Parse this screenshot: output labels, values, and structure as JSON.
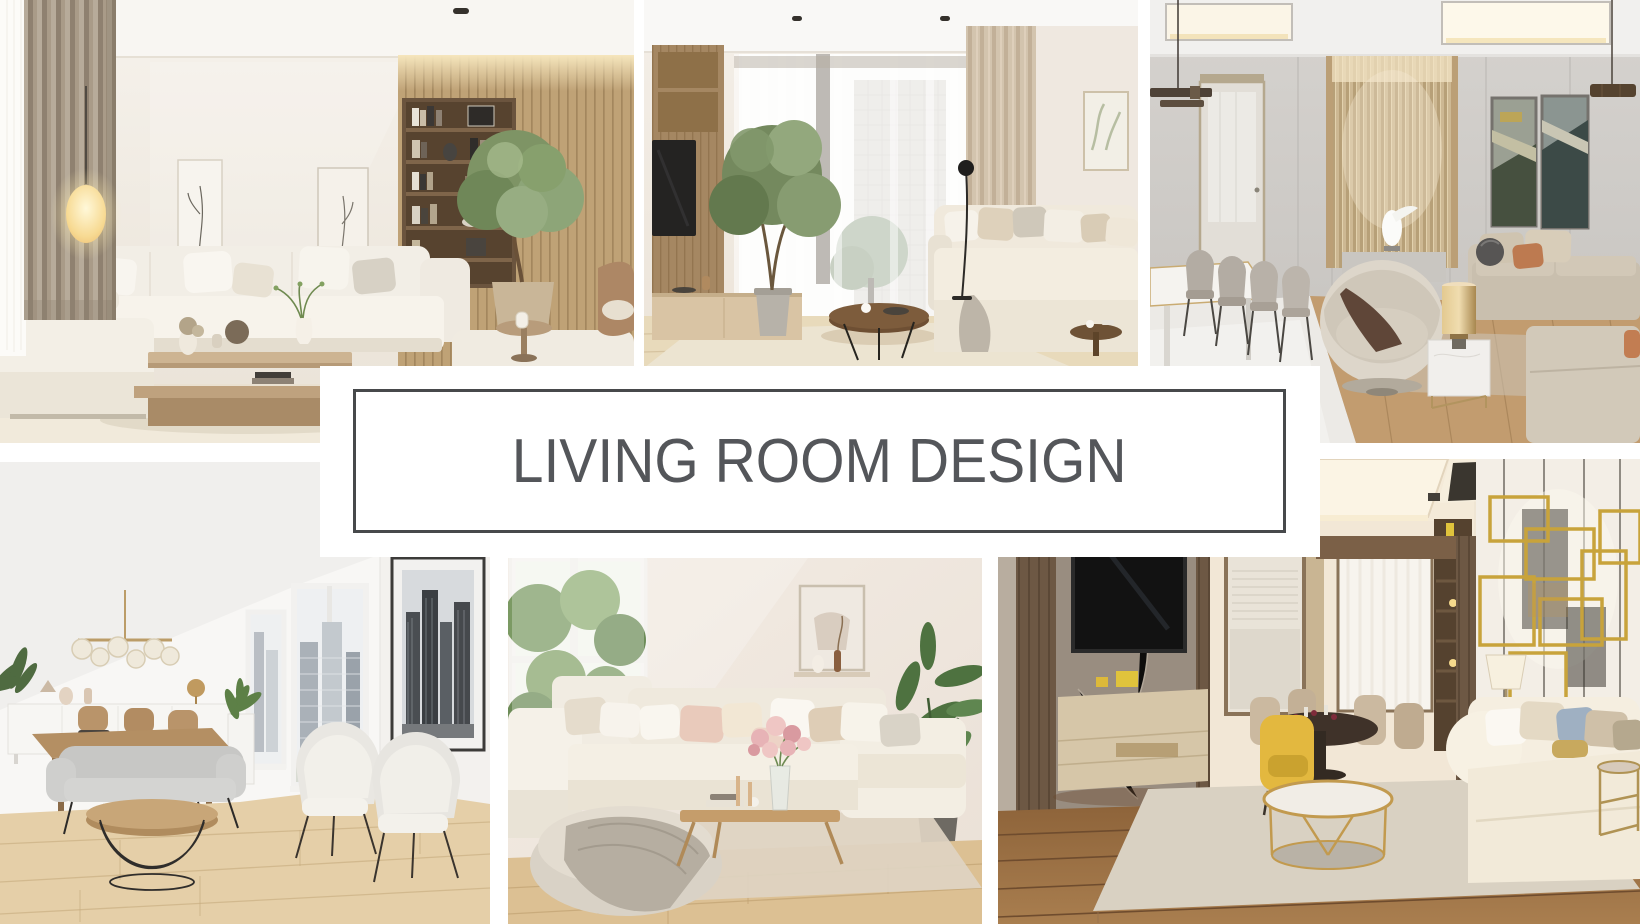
{
  "theme": {
    "page_bg": "#ffffff",
    "banner_bg": "#ffffff",
    "banner_border": "#47494b",
    "banner_text": "#54565a"
  },
  "banner": {
    "title": "LIVING ROOM DESIGN"
  },
  "collage": {
    "photos": [
      {
        "id": "top-left",
        "description": "Bright beige living room: white sectional sofa with pillows, glowing egg floor lamp, taupe pleated curtains, leaning line-art frames, wood slat wall with dark shelving and an indoor tree, light wood coffee table",
        "palette": [
          "#f2eee6",
          "#bfa276",
          "#7e9465",
          "#988a7a"
        ]
      },
      {
        "id": "top-middle",
        "description": "Living room with tall sheer-curtained window onto a tree and building, wood media unit with TV, potted indoor tree, round dark wood coffee table, cream sofa and black floor lamp",
        "palette": [
          "#f0e9e1",
          "#a58762",
          "#74895e",
          "#d3c4ae"
        ]
      },
      {
        "id": "top-right",
        "description": "Elegant gray lounge: champagne fluted feature wall with white sculpture, frosted door, dining table with gray chairs, two dark artworks, beige sofas, round cream armchair, gold cylinder lamp on marble cube table",
        "palette": [
          "#cfccc8",
          "#cdb893",
          "#c9bfae",
          "#bd7a50"
        ]
      },
      {
        "id": "bottom-left",
        "description": "White apartment: brass globe chandelier, white sideboard with dining table and wood chairs, two city-view windows, framed black-and-white skyline print, gray sofa, round wood coffee table on wire base, two cream armchairs, light wood floor",
        "palette": [
          "#f7f6f4",
          "#e3cda6",
          "#c7c7c5",
          "#bb9c68"
        ]
      },
      {
        "id": "bottom-middle",
        "description": "Cozy cream sectional sofa with blush and beige pillows, round pouf with draped throw, wood coffee table with pink flower bouquet and candles, sunny window with greenery, tall leafy plant",
        "palette": [
          "#efe7df",
          "#f1ece2",
          "#e9cabb",
          "#84a269"
        ]
      },
      {
        "id": "bottom-right",
        "description": "Warm modern lounge: marble and wood TV wall with console, dining nook with yellow armchair and dark round table, gold geometric wall art over cream sofa, round gold coffee table on rug, dark wood floor",
        "palette": [
          "#8e8176",
          "#e3b83f",
          "#c8a33b",
          "#7e5a3c"
        ]
      }
    ]
  }
}
